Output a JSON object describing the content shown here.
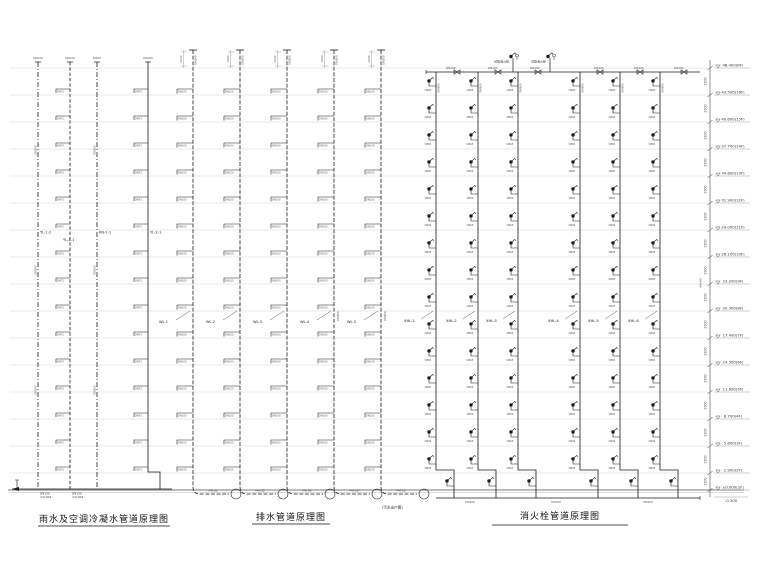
{
  "titles": {
    "rainwater": "雨水及空调冷凝水管道原理图",
    "drainage": "排水管道原理图",
    "hydrant": "消火栓管道原理图"
  },
  "floors": {
    "labels": [
      "46.400(RF)",
      "43.500(16F)",
      "40.600(15F)",
      "37.700(14F)",
      "34.800(13F)",
      "31.900(12F)",
      "29.000(11F)",
      "26.100(10F)",
      "23.200(9F)",
      "20.300(8F)",
      "17.400(7F)",
      "14.500(6F)",
      "11.600(5F)",
      "8.700(4F)",
      "5.800(3F)",
      "2.900(2F)",
      "±0.000(1F)"
    ],
    "below_ground_label": "-0.300",
    "storey_dim": "2900",
    "total_dim": "46400"
  },
  "rainwater": {
    "risers": [
      {
        "id": "YL-1-2",
        "style": "dashdot",
        "top_label": "DN100",
        "has_branches": false
      },
      {
        "id": "YL-1-1",
        "style": "dashed",
        "top_label": "DN100",
        "has_branches": true
      },
      {
        "id": "KN-1-1",
        "style": "dashdot",
        "top_label": "DN50",
        "has_branches": false
      },
      {
        "id": "YL-2-1",
        "style": "solid",
        "top_label": "DN100",
        "has_branches": true
      }
    ],
    "branch_label": "DN75",
    "riser_dim_label": "DN100",
    "outlet_labels": [
      "DN100",
      "i=0.003"
    ]
  },
  "drainage": {
    "risers": [
      {
        "id": "WL-1"
      },
      {
        "id": "WL-2"
      },
      {
        "id": "WL-3"
      },
      {
        "id": "WL-4"
      },
      {
        "id": "WL-5"
      }
    ],
    "vent_height_dim": "2000",
    "vent_side_label": "DN100",
    "branch_label": "DN100",
    "outlet_label": "i=0.02",
    "outlet_note": "(污水出户管)"
  },
  "hydrant": {
    "risers": [
      {
        "id": "XHL-1"
      },
      {
        "id": "XHL-2"
      },
      {
        "id": "XHL-3"
      },
      {
        "id": "XHL-4"
      },
      {
        "id": "XHL-5"
      },
      {
        "id": "XHL-6"
      }
    ],
    "header_label": "DN100",
    "riser_side_label": "DN100",
    "branch_label": "DN65",
    "test_hydrant_label": "试验消火栓",
    "main_label": "DN100"
  }
}
